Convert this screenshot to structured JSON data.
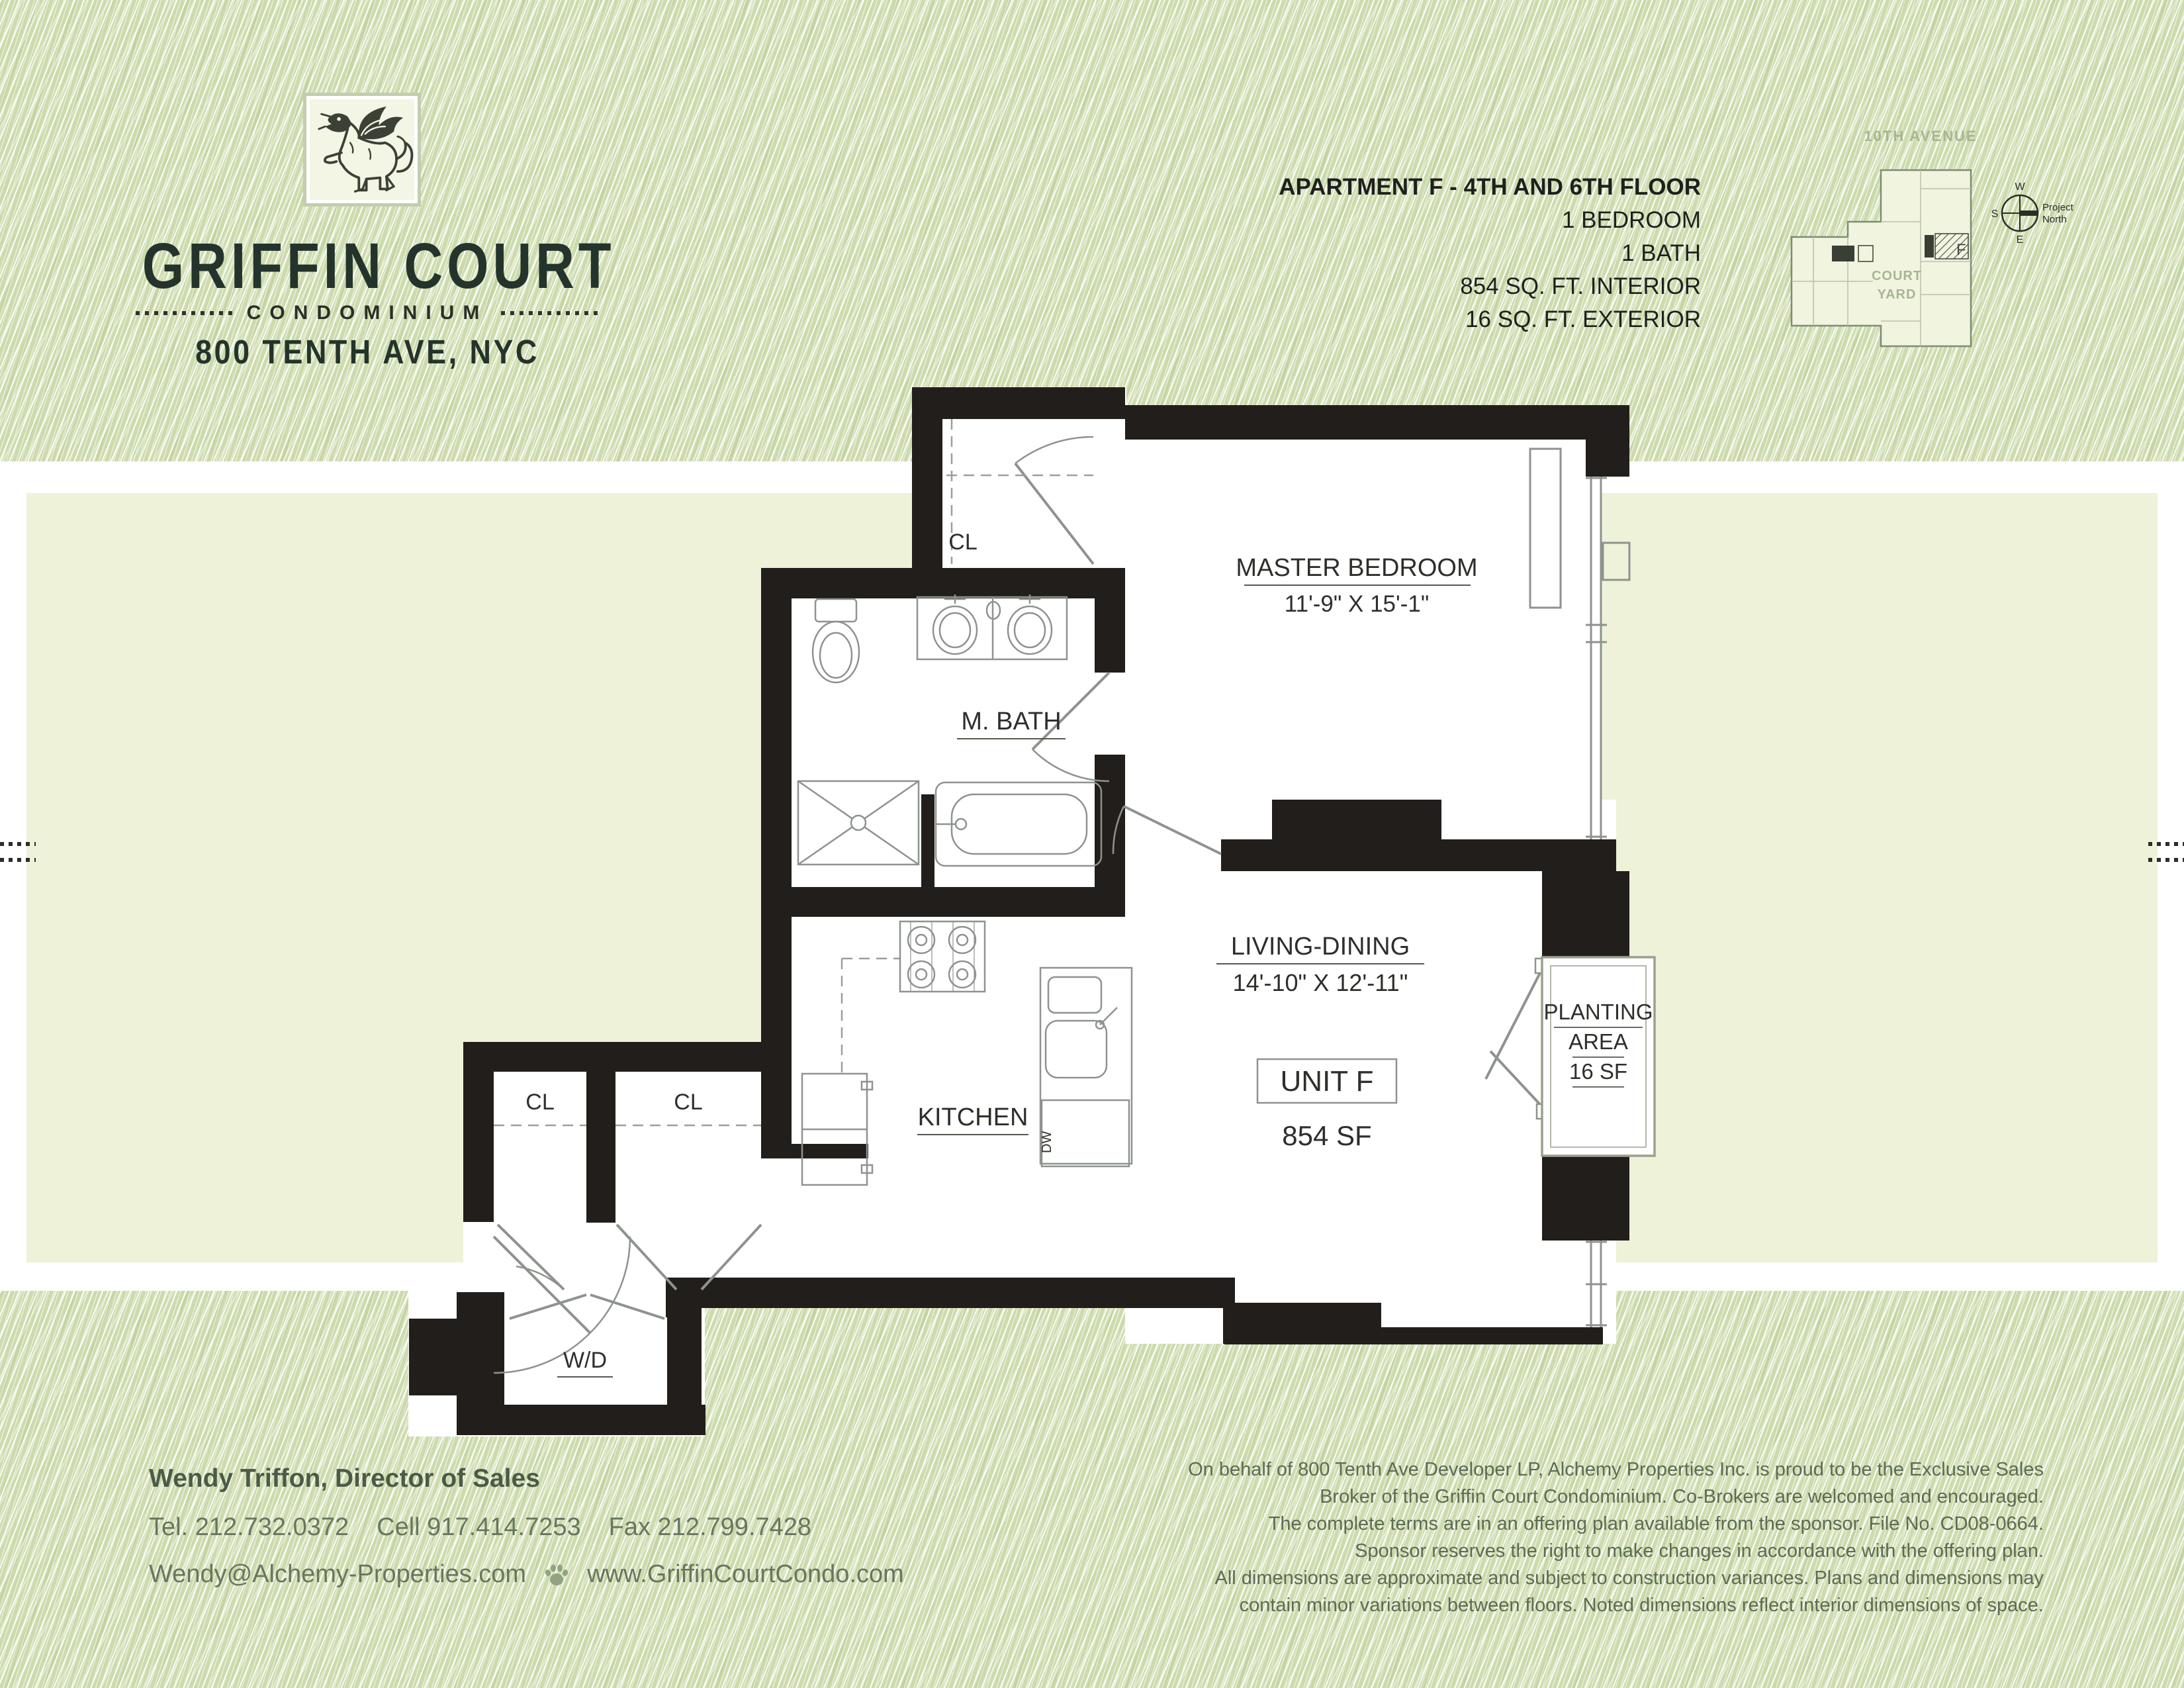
{
  "brand": {
    "name": "GRIFFIN COURT",
    "type": "CONDOMINIUM",
    "address": "800 TENTH AVE, NYC"
  },
  "apartment": {
    "title": "APARTMENT F - 4TH AND 6TH FLOOR",
    "features": [
      "1 BEDROOM",
      "1 BATH",
      "854 SQ. FT. INTERIOR",
      "16 SQ. FT. EXTERIOR"
    ]
  },
  "keyplan": {
    "street": "10TH AVENUE",
    "courtyard_line1": "COURT",
    "courtyard_line2": "YARD",
    "unit_marker": "F",
    "compass": {
      "west": "W",
      "south": "S",
      "east": "E",
      "north_label_line1": "Project",
      "north_label_line2": "North"
    }
  },
  "floorplan": {
    "labels": {
      "closet_top": "CL",
      "master_bedroom": "MASTER BEDROOM",
      "master_bedroom_dim": "11'-9\" X 15'-1\"",
      "master_bath": "M. BATH",
      "living_dining": "LIVING-DINING",
      "living_dining_dim": "14'-10\" X 12'-11\"",
      "planting_line1": "PLANTING",
      "planting_line2": "AREA",
      "planting_line3": "16 SF",
      "unit": "UNIT F",
      "unit_area": "854 SF",
      "kitchen": "KITCHEN",
      "closet_1": "CL",
      "closet_2": "CL",
      "washer_dryer": "W/D",
      "dishwasher": "DW"
    }
  },
  "contact": {
    "name": "Wendy Triffon, Director of Sales",
    "tel": "Tel. 212.732.0372",
    "cell": "Cell 917.414.7253",
    "fax": "Fax 212.799.7428",
    "email": "Wendy@Alchemy-Properties.com",
    "website": "www.GriffinCourtCondo.com"
  },
  "legal": {
    "line1": "On behalf of 800 Tenth Ave Developer LP, Alchemy Properties Inc. is proud to be the Exclusive Sales",
    "line2": "Broker of the Griffin Court Condominium. Co-Brokers are welcomed and encouraged.",
    "line3": "The complete terms are in an offering plan available from the sponsor. File No. CD08-0664.",
    "line4": "Sponsor reserves the right to make changes in accordance with the offering plan.",
    "line5": "All dimensions are approximate and subject to construction variances. Plans and dimensions may",
    "line6": "contain minor variations between floors. Noted dimensions reflect interior dimensions of space."
  },
  "colors": {
    "band_green": "#ccdbac",
    "panel_green": "#edf2d9",
    "wall_black": "#211e1c",
    "brand_dark_green": "#24332b",
    "muted_keyplan_text": "#a8b593",
    "footer_text": "#5c6b54"
  }
}
